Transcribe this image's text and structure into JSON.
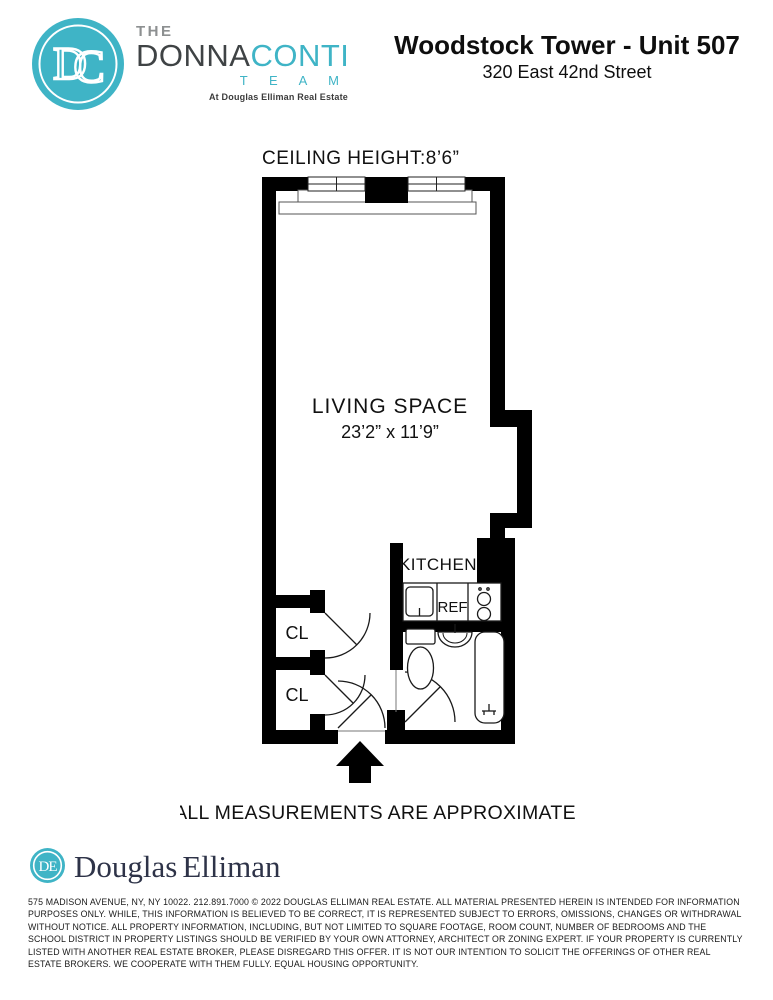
{
  "header": {
    "brand": {
      "monogram": "DC",
      "the": "THE",
      "name_primary": "DONNA",
      "name_secondary": "CONTI",
      "team": "T E A M",
      "tagline": "At Douglas Elliman Real Estate",
      "teal": "#3FB4C6",
      "dark_gray": "#3F4345"
    },
    "title": "Woodstock Tower - Unit 507",
    "address": "320 East 42nd Street"
  },
  "floorplan": {
    "ceiling_height_label": "CEILING HEIGHT:8’6”",
    "living_space": {
      "name": "LIVING SPACE",
      "dimensions": "23’2” x 11’9”"
    },
    "kitchen_label": "KITCHEN",
    "refrigerator_label": "REF",
    "closet1_label": "CL",
    "closet2_label": "CL",
    "note": "ALL MEASUREMENTS ARE APPROXIMATE",
    "wall_color": "#000000"
  },
  "footer": {
    "brokerage": {
      "monogram": "DE",
      "name_first": "Douglas",
      "name_last": "Elliman",
      "teal": "#3FB4C6",
      "navy": "#2E3348"
    },
    "disclaimer": "575 MADISON AVENUE, NY, NY 10022. 212.891.7000 © 2022 DOUGLAS ELLIMAN REAL ESTATE. ALL MATERIAL PRESENTED HEREIN IS INTENDED FOR INFORMATION PURPOSES ONLY. WHILE, THIS INFORMATION IS BELIEVED TO BE CORRECT, IT IS REPRESENTED SUBJECT TO ERRORS, OMISSIONS, CHANGES OR WITHDRAWAL WITHOUT NOTICE. ALL PROPERTY INFORMATION, INCLUDING, BUT NOT LIMITED TO SQUARE FOOTAGE, ROOM COUNT, NUMBER OF BEDROOMS AND THE SCHOOL DISTRICT IN PROPERTY LISTINGS SHOULD BE VERIFIED BY YOUR OWN ATTORNEY, ARCHITECT OR ZONING EXPERT. IF YOUR PROPERTY IS CURRENTLY LISTED WITH ANOTHER REAL ESTATE BROKER, PLEASE DISREGARD THIS OFFER. IT IS NOT OUR INTENTION TO SOLICIT THE OFFERINGS OF OTHER REAL ESTATE BROKERS. WE COOPERATE WITH THEM FULLY. EQUAL HOUSING OPPORTUNITY."
  }
}
